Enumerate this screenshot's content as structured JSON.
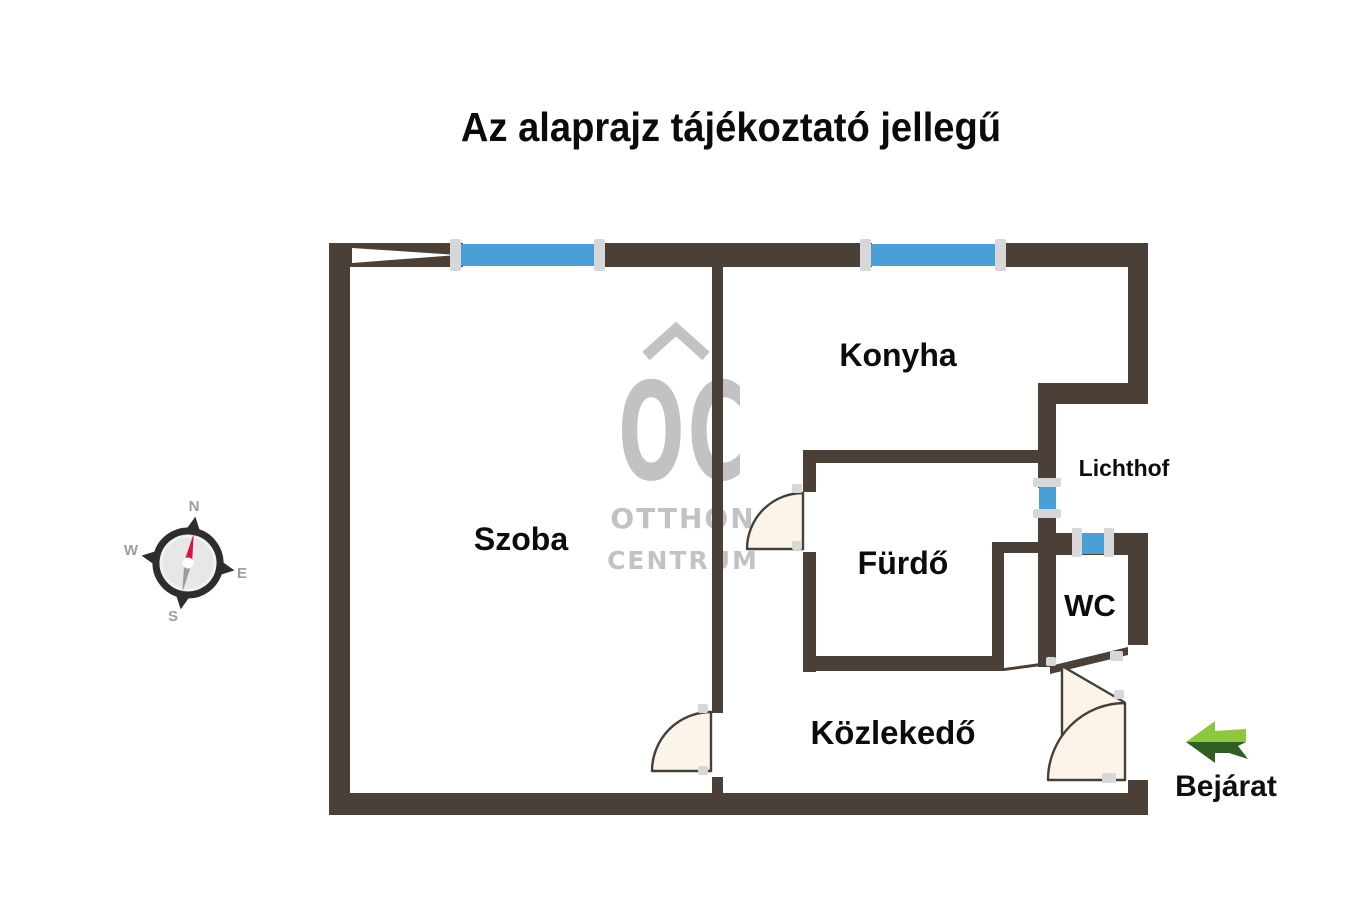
{
  "title": "Az alaprajz tájékoztató jellegű",
  "rooms": {
    "szoba": "Szoba",
    "konyha": "Konyha",
    "furdo": "Fürdő",
    "wc": "WC",
    "lichthof": "Lichthof",
    "kozlekedo": "Közlekedő"
  },
  "entrance": {
    "label": "Bejárat"
  },
  "compass": {
    "north": "N",
    "west": "W",
    "east": "E",
    "south": "S"
  },
  "watermark": {
    "initials": "OC",
    "line1": "OTTHON",
    "line2": "CENTRUM"
  },
  "colors": {
    "wall": "#4b4037",
    "window": "#4aa0d6",
    "door_fill": "#fcf4e8",
    "door_stroke": "#46403b",
    "arrow_light": "#8dc63f",
    "arrow_dark": "#2f5e22",
    "compass_needle_red": "#d4163c",
    "compass_needle_gray": "#9a9a9a",
    "watermark_gray": "#b4b4b4",
    "label_black": "#0c0c0c"
  }
}
